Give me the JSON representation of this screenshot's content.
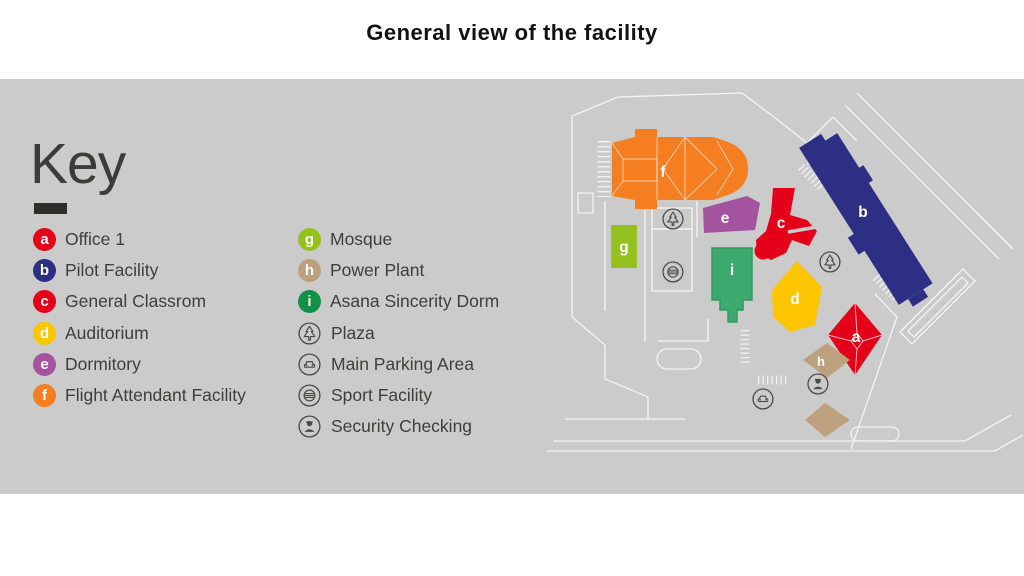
{
  "title": "General view of the facility",
  "key": {
    "heading": "Key",
    "items_letters": [
      {
        "letter": "a",
        "label": "Office 1",
        "color": "#e30018"
      },
      {
        "letter": "b",
        "label": "Pilot Facility",
        "color": "#2d2f84"
      },
      {
        "letter": "c",
        "label": "General Classrom",
        "color": "#e30018"
      },
      {
        "letter": "d",
        "label": "Auditorium",
        "color": "#fdc600"
      },
      {
        "letter": "e",
        "label": "Dormitory",
        "color": "#a4539f"
      },
      {
        "letter": "f",
        "label": "Flight Attendant Facility",
        "color": "#f47e20"
      },
      {
        "letter": "g",
        "label": "Mosque",
        "color": "#94c11e"
      },
      {
        "letter": "h",
        "label": "Power Plant",
        "color": "#bda17f"
      },
      {
        "letter": "i",
        "label": "Asana Sincerity Dorm",
        "color": "#0f9246"
      }
    ],
    "items_icons": [
      {
        "icon": "tree-icon",
        "label": "Plaza"
      },
      {
        "icon": "car-icon",
        "label": "Main Parking Area"
      },
      {
        "icon": "ball-icon",
        "label": "Sport Facility"
      },
      {
        "icon": "guard-icon",
        "label": "Security Checking"
      }
    ]
  },
  "map": {
    "buildings": [
      {
        "letter": "a",
        "name": "Office 1",
        "color": "#e30018"
      },
      {
        "letter": "b",
        "name": "Pilot Facility",
        "color": "#2d2f84"
      },
      {
        "letter": "c",
        "name": "General Classrom",
        "color": "#e30018"
      },
      {
        "letter": "d",
        "name": "Auditorium",
        "color": "#fdc600"
      },
      {
        "letter": "e",
        "name": "Dormitory",
        "color": "#a4539f"
      },
      {
        "letter": "f",
        "name": "Flight Attendant Facility",
        "color": "#f47e20"
      },
      {
        "letter": "g",
        "name": "Mosque",
        "color": "#94c11e"
      },
      {
        "letter": "h",
        "name": "Power Plant",
        "color": "#bda17f"
      },
      {
        "letter": "i",
        "name": "Asana Sincerity Dorm",
        "color": "#3ca96e"
      }
    ]
  },
  "colors": {
    "band": "#cbcbcb",
    "text": "#3e3e3d",
    "road": "#ffffff"
  }
}
